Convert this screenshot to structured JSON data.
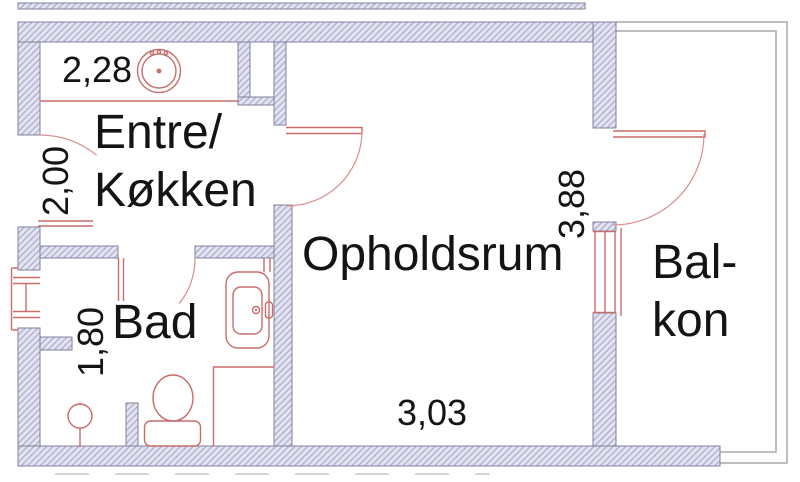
{
  "plan": {
    "rooms": [
      {
        "name": "entre-kokken",
        "label_line1": "Entre/",
        "label_line2": "Køkken"
      },
      {
        "name": "opholdsrum",
        "label": "Opholdsrum"
      },
      {
        "name": "bad",
        "label": "Bad"
      },
      {
        "name": "balkon",
        "label_line1": "Bal-",
        "label_line2": "kon"
      }
    ],
    "dimensions": [
      {
        "name": "kitchen-counter-width",
        "value": "2,28"
      },
      {
        "name": "entre-width",
        "value": "2,00"
      },
      {
        "name": "bad-width",
        "value": "1,80"
      },
      {
        "name": "opholdsrum-depth",
        "value": "3,88"
      },
      {
        "name": "opholdsrum-width",
        "value": "3,03"
      }
    ],
    "fixtures": [
      {
        "name": "kitchen-counter"
      },
      {
        "name": "kitchen-sink"
      },
      {
        "name": "entrance-door"
      },
      {
        "name": "living-room-door"
      },
      {
        "name": "bathroom-door"
      },
      {
        "name": "balcony-door"
      },
      {
        "name": "bathroom-window"
      },
      {
        "name": "balcony-window"
      },
      {
        "name": "washbasin"
      },
      {
        "name": "toilet"
      },
      {
        "name": "floor-drain"
      },
      {
        "name": "shower-corner"
      },
      {
        "name": "duct-niche"
      },
      {
        "name": "balcony-railing"
      }
    ],
    "colors": {
      "wall_fill": "#e4e4f1",
      "wall_hatch": "#a3a3c8",
      "wall_outline": "#80809b",
      "fixture_red": "#c96c6c",
      "door_arc_red": "#d98f8f",
      "railing_gray": "#a8a8a8",
      "label_text": "#141414"
    }
  }
}
